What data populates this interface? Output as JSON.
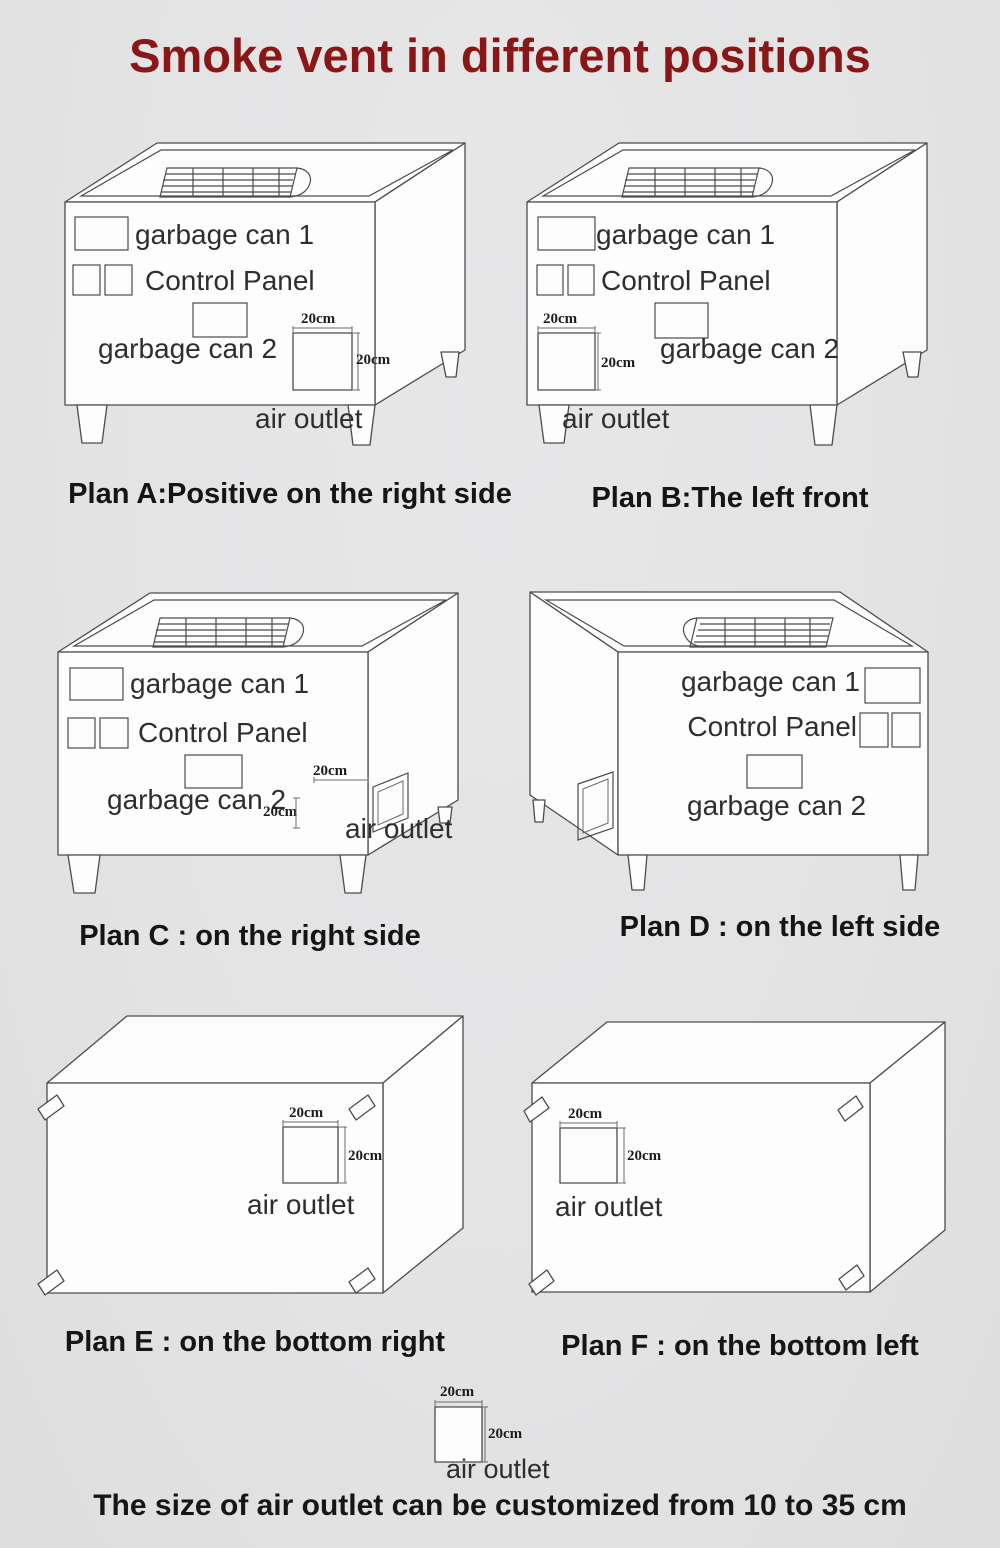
{
  "page": {
    "title": "Smoke vent in different positions",
    "footer_note": "The size of air outlet can be customized from 10 to 35 cm"
  },
  "labels": {
    "garbage_can_1": "garbage can 1",
    "garbage_can_2": "garbage can 2",
    "control_panel": "Control Panel",
    "air_outlet": "air outlet",
    "dim_20cm": "20cm"
  },
  "plans": [
    {
      "id": "A",
      "caption": "Plan A:Positive on the right side"
    },
    {
      "id": "B",
      "caption": "Plan B:The left front"
    },
    {
      "id": "C",
      "caption": "Plan C : on the right side"
    },
    {
      "id": "D",
      "caption": "Plan D : on the left side"
    },
    {
      "id": "E",
      "caption": "Plan E : on the bottom right"
    },
    {
      "id": "F",
      "caption": "Plan F : on the bottom left"
    }
  ],
  "colors": {
    "title": "#8a1717",
    "background": "#e4e4e5",
    "line": "#4c4c4c",
    "label_text": "#2e2e2e",
    "caption_text": "#151515",
    "box_face": "#fdfdfd"
  }
}
